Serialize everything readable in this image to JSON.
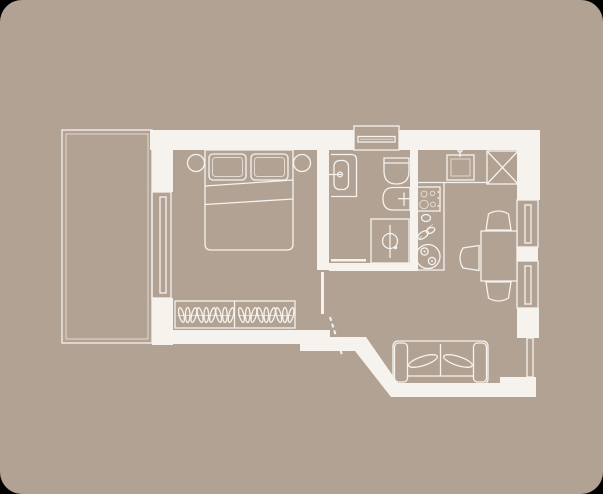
{
  "plan": {
    "type": "apartment-floor-plan",
    "title": "Apartment floor plan",
    "rooms": [
      {
        "id": "bedroom",
        "furniture": [
          "double-bed",
          "pillows",
          "nightstand-left",
          "nightstand-right",
          "wardrobe-with-hangers"
        ]
      },
      {
        "id": "balcony",
        "furniture": []
      },
      {
        "id": "bathroom",
        "furniture": [
          "washbasin",
          "toilet",
          "bidet",
          "shower"
        ]
      },
      {
        "id": "kitchen",
        "furniture": [
          "counter",
          "sink",
          "stove",
          "fridge",
          "cup",
          "decor-sketch",
          "round-decor"
        ]
      },
      {
        "id": "living-room",
        "furniture": [
          "sofa",
          "dining-table",
          "chair-top",
          "chair-left",
          "chair-bottom"
        ]
      },
      {
        "id": "hallway",
        "furniture": [
          "entry-door-swing"
        ]
      }
    ],
    "windows": [
      "top-window",
      "left-window",
      "right-window-1",
      "right-window-2",
      "lower-right-window"
    ]
  },
  "wardrobe": {
    "sections": 2,
    "hangers_per_section": 9
  },
  "colors": {
    "page_bg": "#000000",
    "floor": "#b1a294",
    "wall_line": "#f6f3ee",
    "soft_line": "#e3dbd1"
  }
}
